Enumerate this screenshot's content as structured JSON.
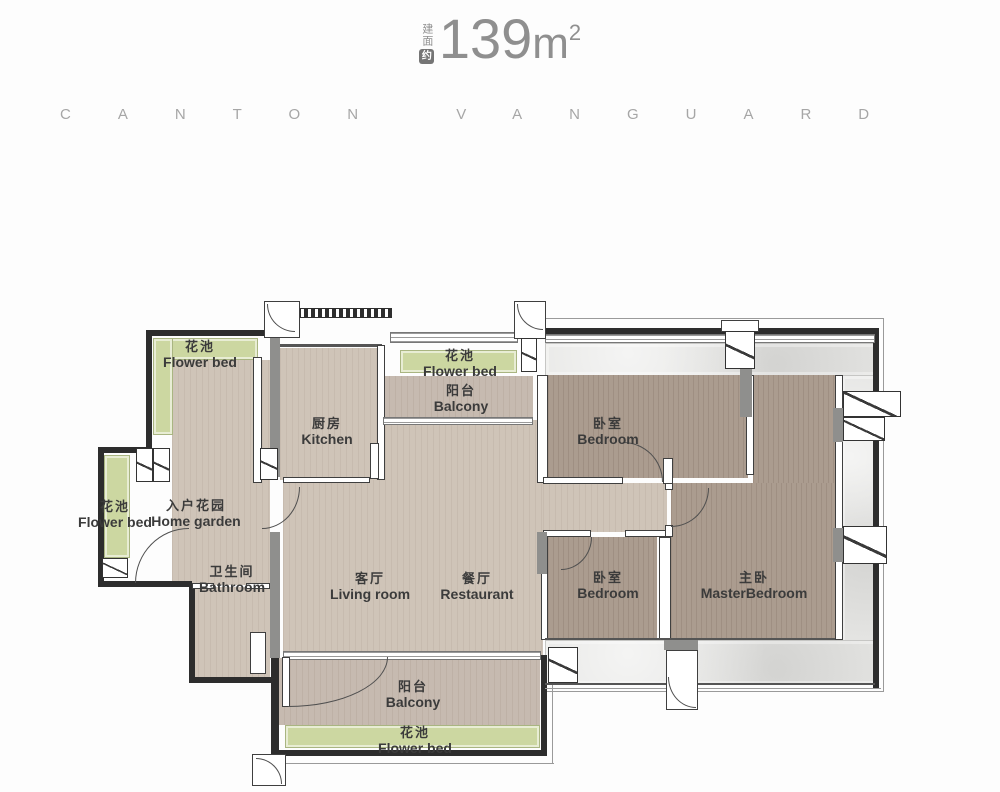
{
  "header": {
    "area_prefix": "建面",
    "area_badge": "约",
    "area_value": "139",
    "area_unit": "m",
    "area_sup": "2",
    "brand": "CANTON VANGUARD"
  },
  "palette": {
    "wood_light": "#cfc4b8",
    "wood_mid": "#c6bab0",
    "wood_dark": "#ab9c8f",
    "green": "#ccd7a1",
    "marble": "#e4e4e2",
    "wall_dark": "#2d2d2d",
    "wall_gray": "#8f8f8d",
    "label": "#3b3b3b",
    "header_gray": "#8f8f8f",
    "brand_gray": "#a6a6a6"
  },
  "rooms": [
    {
      "id": "flower-bed-top-left",
      "zh": "花池",
      "en": "Flower bed"
    },
    {
      "id": "flower-bed-top-center",
      "zh": "花池",
      "en": "Flower bed"
    },
    {
      "id": "balcony-top",
      "zh": "阳台",
      "en": "Balcony"
    },
    {
      "id": "kitchen",
      "zh": "厨房",
      "en": "Kitchen"
    },
    {
      "id": "bedroom-top",
      "zh": "卧室",
      "en": "Bedroom"
    },
    {
      "id": "flower-bed-left",
      "zh": "花池",
      "en": "Flower bed"
    },
    {
      "id": "home-garden",
      "zh": "入户花园",
      "en": "Home garden"
    },
    {
      "id": "bathroom",
      "zh": "卫生间",
      "en": "Bathroom"
    },
    {
      "id": "living-room",
      "zh": "客厅",
      "en": "Living room"
    },
    {
      "id": "restaurant",
      "zh": "餐厅",
      "en": "Restaurant"
    },
    {
      "id": "bedroom-bottom",
      "zh": "卧室",
      "en": "Bedroom"
    },
    {
      "id": "master-bedroom",
      "zh": "主卧",
      "en": "MasterBedroom"
    },
    {
      "id": "balcony-bottom",
      "zh": "阳台",
      "en": "Balcony"
    },
    {
      "id": "flower-bed-bottom",
      "zh": "花池",
      "en": "Flower bed"
    }
  ]
}
